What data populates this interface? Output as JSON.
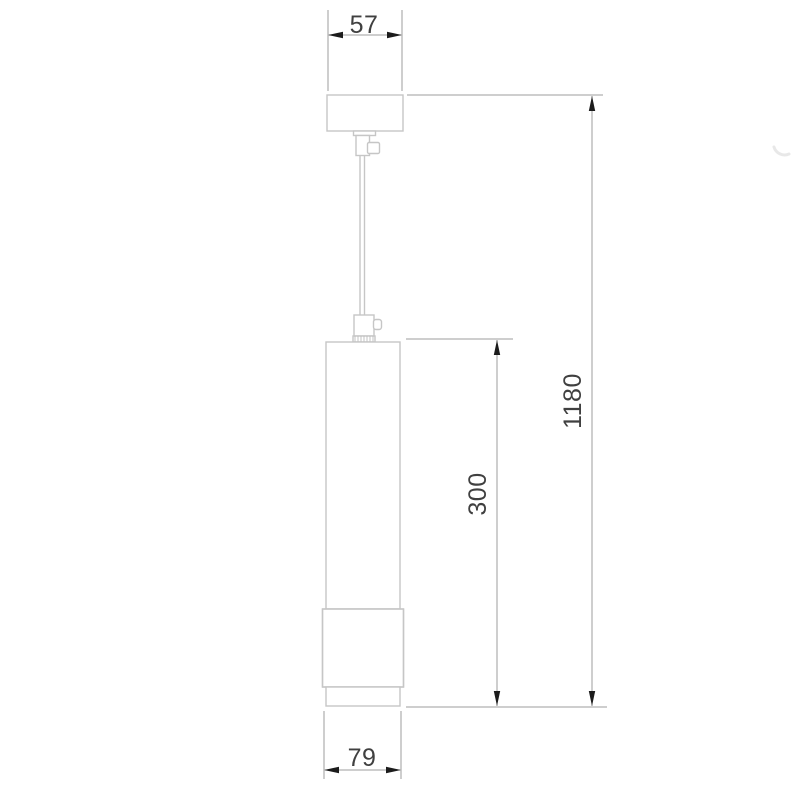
{
  "drawing": {
    "title": "pendant-lamp-dimension-drawing",
    "dims": {
      "canopy_width": "57",
      "overall_height": "1180",
      "body_height": "300",
      "body_width": "79"
    },
    "colors": {
      "background": "#ffffff",
      "fixture_outline": "#c6c6c6",
      "dimension_line": "#9c9c9c",
      "arrow": "#1c1c1c",
      "text": "#404040",
      "watermark": "#e8e8e8"
    }
  }
}
